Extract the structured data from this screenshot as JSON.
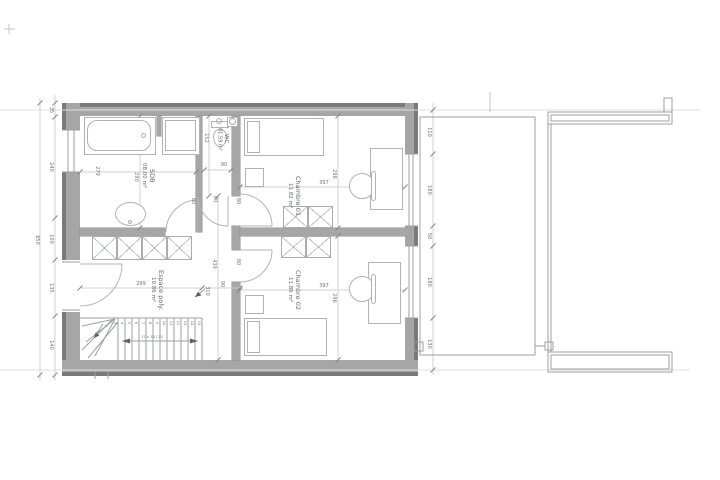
{
  "rooms": {
    "sdb": {
      "name": "SDB",
      "area": "08.00 m²"
    },
    "wc": {
      "name": "WC",
      "area": "01.59 m²"
    },
    "chambre01": {
      "name": "Chambre 01",
      "area": "11.82 m²"
    },
    "chambre02": {
      "name": "Chambre 02",
      "area": "11.86 m²"
    },
    "espace_poly": {
      "name": "Espace poly.",
      "area": "10.86 m²"
    }
  },
  "dims": {
    "left_total": "650",
    "left_chain": [
      "35",
      "240",
      "100",
      "135",
      "140"
    ],
    "right_chain": [
      "110",
      "180",
      "50",
      "180",
      "130"
    ],
    "sdb": {
      "width": "279",
      "height": "290"
    },
    "wc": {
      "height": "152",
      "width": "90"
    },
    "chambre01": {
      "width": "397",
      "height": "298"
    },
    "chambre02": {
      "width": "397",
      "height": "296"
    },
    "espace_poly": {
      "width": "299",
      "hall_length": "439",
      "hall_width": "90",
      "stair_opening": "310"
    },
    "doors": {
      "sdb": "80",
      "wc": "80",
      "chambre01": "80",
      "chambre02": "80"
    }
  },
  "stairs": {
    "steps": [
      "1",
      "2",
      "3",
      "4",
      "5",
      "6",
      "7",
      "8",
      "9",
      "10",
      "11",
      "12",
      "13",
      "14",
      "15"
    ],
    "walkline_label": "17 x 18 / 25"
  },
  "colors": {
    "wall": "#a6a6a6",
    "wall_outer": "#7a7a7a",
    "line": "#9ba0a2",
    "dim_line": "#cdd1d3",
    "text": "#6d7275"
  }
}
